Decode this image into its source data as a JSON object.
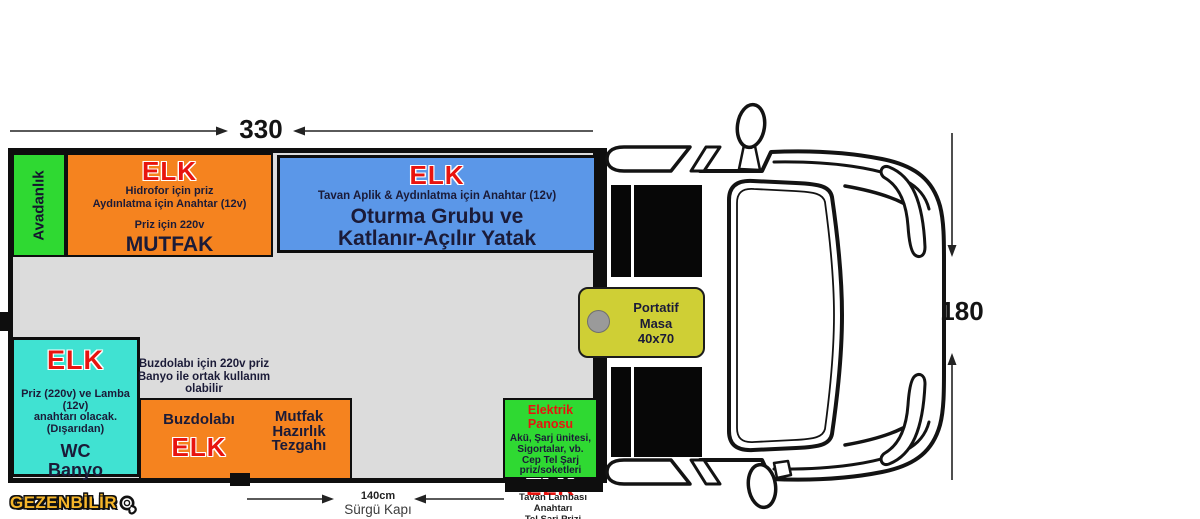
{
  "dimensions": {
    "width_label": "330",
    "height_label": "180",
    "door_width": "140cm",
    "door_name": "Sürgü Kapı"
  },
  "plan": {
    "avadanlik": {
      "label": "Avadanlık"
    },
    "mutfak": {
      "elk": "ELK",
      "note1": "Hidrofor için priz",
      "note2": "Aydınlatma için Anahtar (12v)",
      "note3": "Priz için 220v",
      "name": "MUTFAK"
    },
    "oturma": {
      "elk": "ELK",
      "note": "Tavan Aplik & Aydınlatma için Anahtar (12v)",
      "name_line1": "Oturma Grubu ve",
      "name_line2": "Katlanır-Açılır Yatak"
    },
    "wc": {
      "elk": "ELK",
      "note1": "Priz (220v) ve Lamba (12v)",
      "note2": "anahtarı olacak.",
      "note3": "(Dışarıdan)",
      "name_line1": "WC",
      "name_line2": "Banyo"
    },
    "buzdolabi_note": {
      "line1": "Buzdolabı için 220v priz",
      "line2": "Banyo ile ortak kullanım",
      "line3": "olabilir"
    },
    "tezgah": {
      "left_name": "Buzdolabı",
      "elk": "ELK",
      "right_line1": "Mutfak",
      "right_line2": "Hazırlık",
      "right_line3": "Tezgahı"
    },
    "panel": {
      "name": "Elektrik Panosu",
      "note1": "Akü, Şarj ünitesi,",
      "note2": "Sigortalar, vb.",
      "note3": "Cep Tel Şarj",
      "note4": "priz/soketleri",
      "elk": "ELK"
    },
    "masa": {
      "line1": "Portatif",
      "line2": "Masa",
      "line3": "40x70"
    }
  },
  "footer": {
    "roof_note_line1": "Tavan Lambası Anahtarı",
    "roof_note_line2": "Tel Şarj Prizi",
    "logo": "GEZENBİLİR"
  },
  "colors": {
    "plan_bg": "#dcdcdc",
    "orange": "#f5831f",
    "blue": "#5b97e8",
    "green": "#2fd932",
    "turquoise": "#40e2d2",
    "table_yellow": "#cfcf35",
    "elk_red": "#e8140f",
    "logo_yellow": "#f6b62a",
    "line_black": "#111111"
  }
}
